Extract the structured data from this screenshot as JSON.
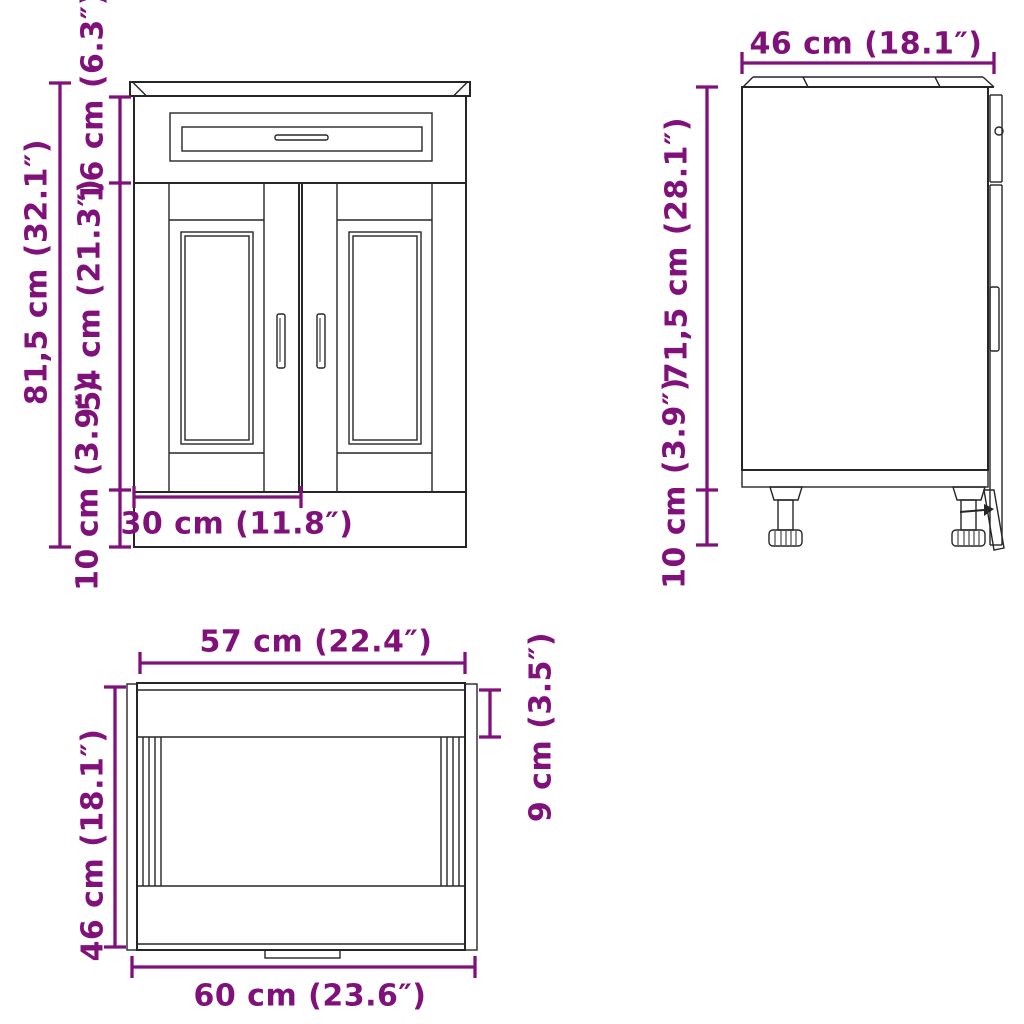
{
  "colors": {
    "dimension_accent": "#81117A",
    "line_color": "#262626",
    "background": "#FFFFFF"
  },
  "front_view": {
    "dim_total_height": "81,5 cm (32.1″)",
    "dim_drawer_height": "16 cm (6.3″)",
    "dim_door_height": "54 cm (21.3″)",
    "dim_plinth_height": "10 cm (3.9″)",
    "dim_door_width": "30 cm (11.8″)"
  },
  "side_view": {
    "dim_depth": "46 cm (18.1″)",
    "dim_body_height": "71,5 cm (28.1″)",
    "dim_feet_height": "10 cm (3.9″)"
  },
  "top_view": {
    "dim_top_width": "57 cm (22.4″)",
    "dim_frame_depth": "9 cm (3.5″)",
    "dim_depth": "46 cm (18.1″)",
    "dim_total_width": "60 cm (23.6″)"
  }
}
